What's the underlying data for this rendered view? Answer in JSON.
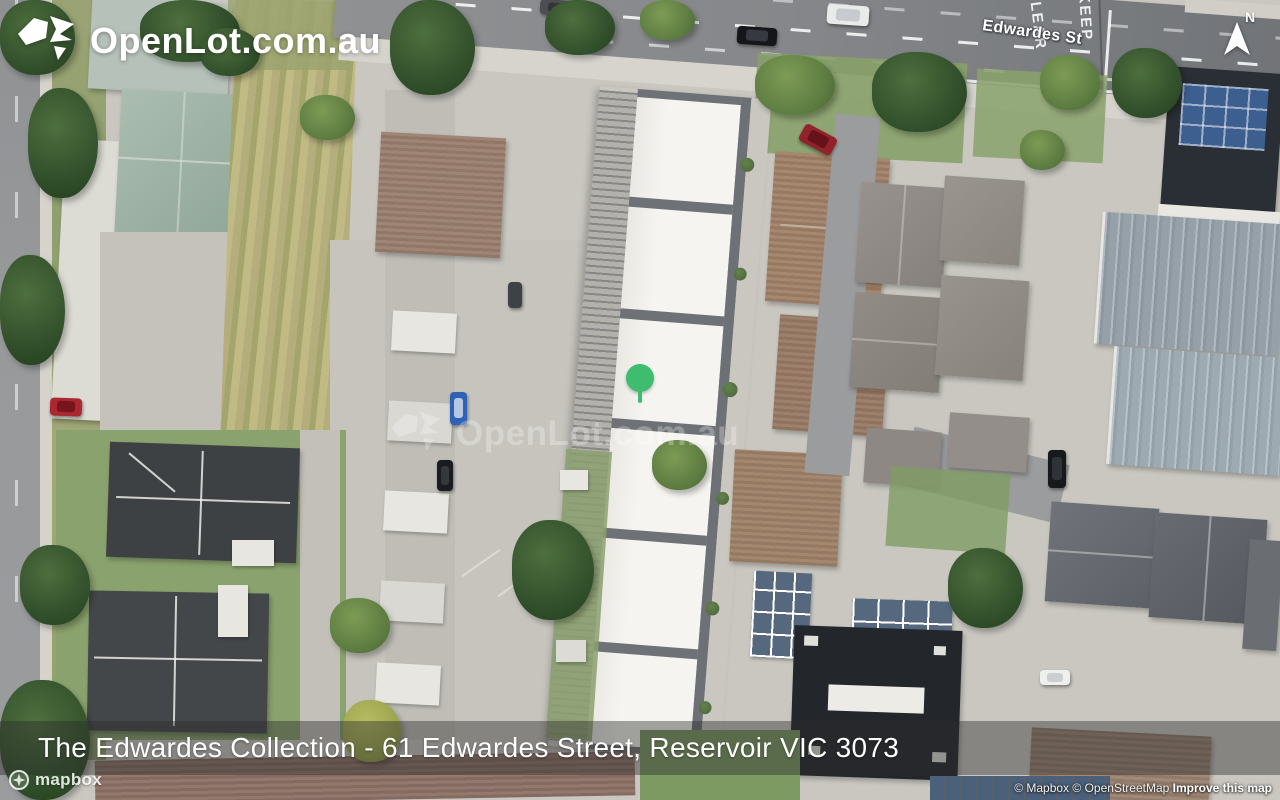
{
  "brand": {
    "logo_text": "OpenLot.com.au"
  },
  "map": {
    "street_label": "Edwardes St",
    "road_marking": {
      "word1": "KEEP",
      "word2": "CLEAR"
    },
    "watermark_text": "OpenLot.com.au",
    "north_indicator": "N",
    "marker_color": "#3ebd6e"
  },
  "banner": {
    "title": "The Edwardes Collection - 61 Edwardes Street, Reservoir VIC 3073"
  },
  "footer": {
    "mapbox_wordmark": "mapbox",
    "attribution": {
      "mapbox": "© Mapbox",
      "osm": "© OpenStreetMap",
      "improve": "Improve this map"
    }
  }
}
